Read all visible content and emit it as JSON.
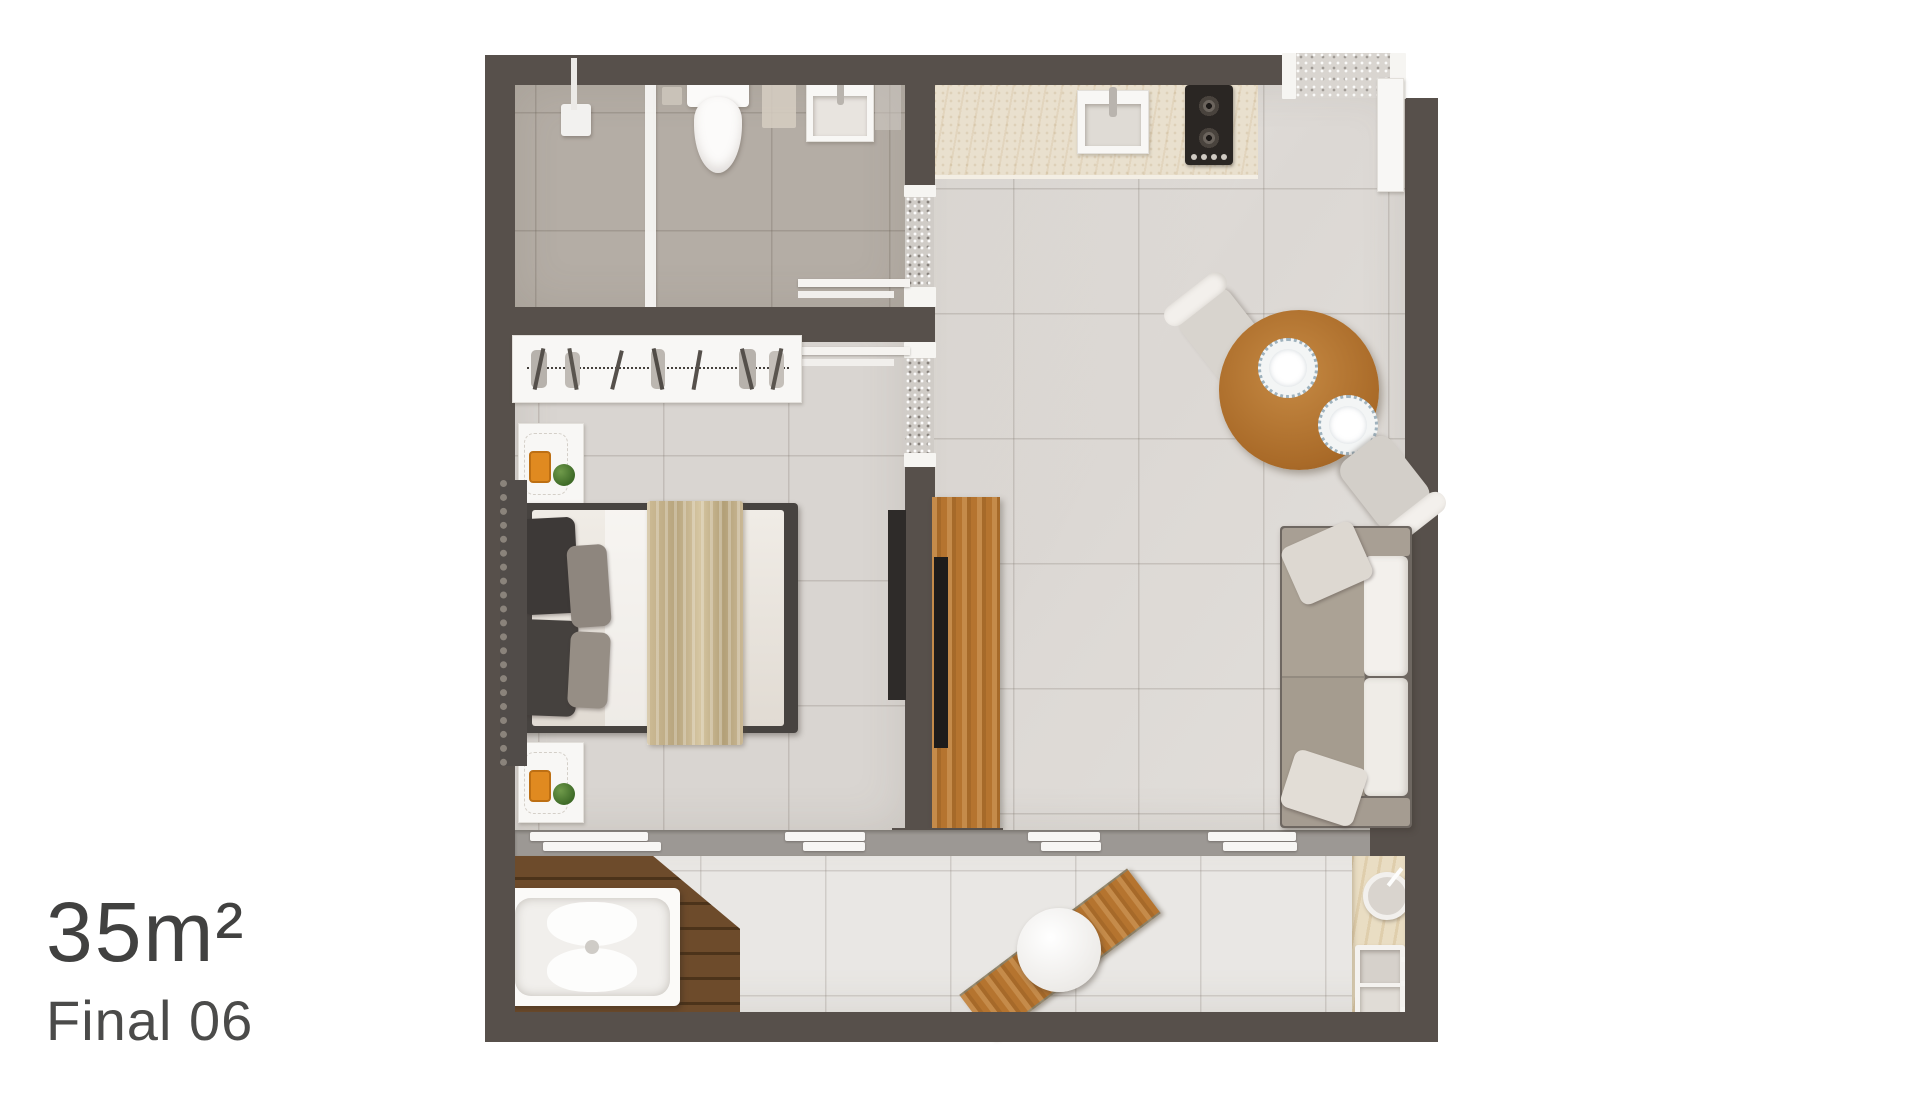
{
  "caption": {
    "area": "35m²",
    "unit": "Final 06"
  },
  "palette": {
    "page_bg": "#ffffff",
    "wall": "#57504b",
    "bathroom_floor": "#b4ada5",
    "bedroom_floor": "#d9d5d1",
    "living_floor": "#dfdbd7",
    "balcony_floor": "#e9e7e4",
    "counter": "#e9e0ce",
    "wood": "#b5742f",
    "deck_wood": "#6d4b2b",
    "tv_black": "#2a2623",
    "glass_block": "#d0ccc7",
    "sofa_seat": "#aba295",
    "sofa_back": "#f3f0ec",
    "bed_duvet": "#ece7e0",
    "bed_throw": "#c8b690",
    "lamp_accent": "#e08a20",
    "plant_green": "#4c7c33"
  },
  "furniture": [
    "shower",
    "glass-screen",
    "toilet",
    "bathroom-vanity",
    "towel-shelves",
    "wardrobe",
    "bed",
    "nightstand",
    "tv-partition",
    "kitchen-counter",
    "kitchen-sink",
    "cooktop",
    "dining-table",
    "dining-chair",
    "sofa",
    "entry-door",
    "sliding-door",
    "wood-deck",
    "hot-tub",
    "patio-table",
    "patio-bench",
    "outdoor-counter",
    "outdoor-sink"
  ]
}
